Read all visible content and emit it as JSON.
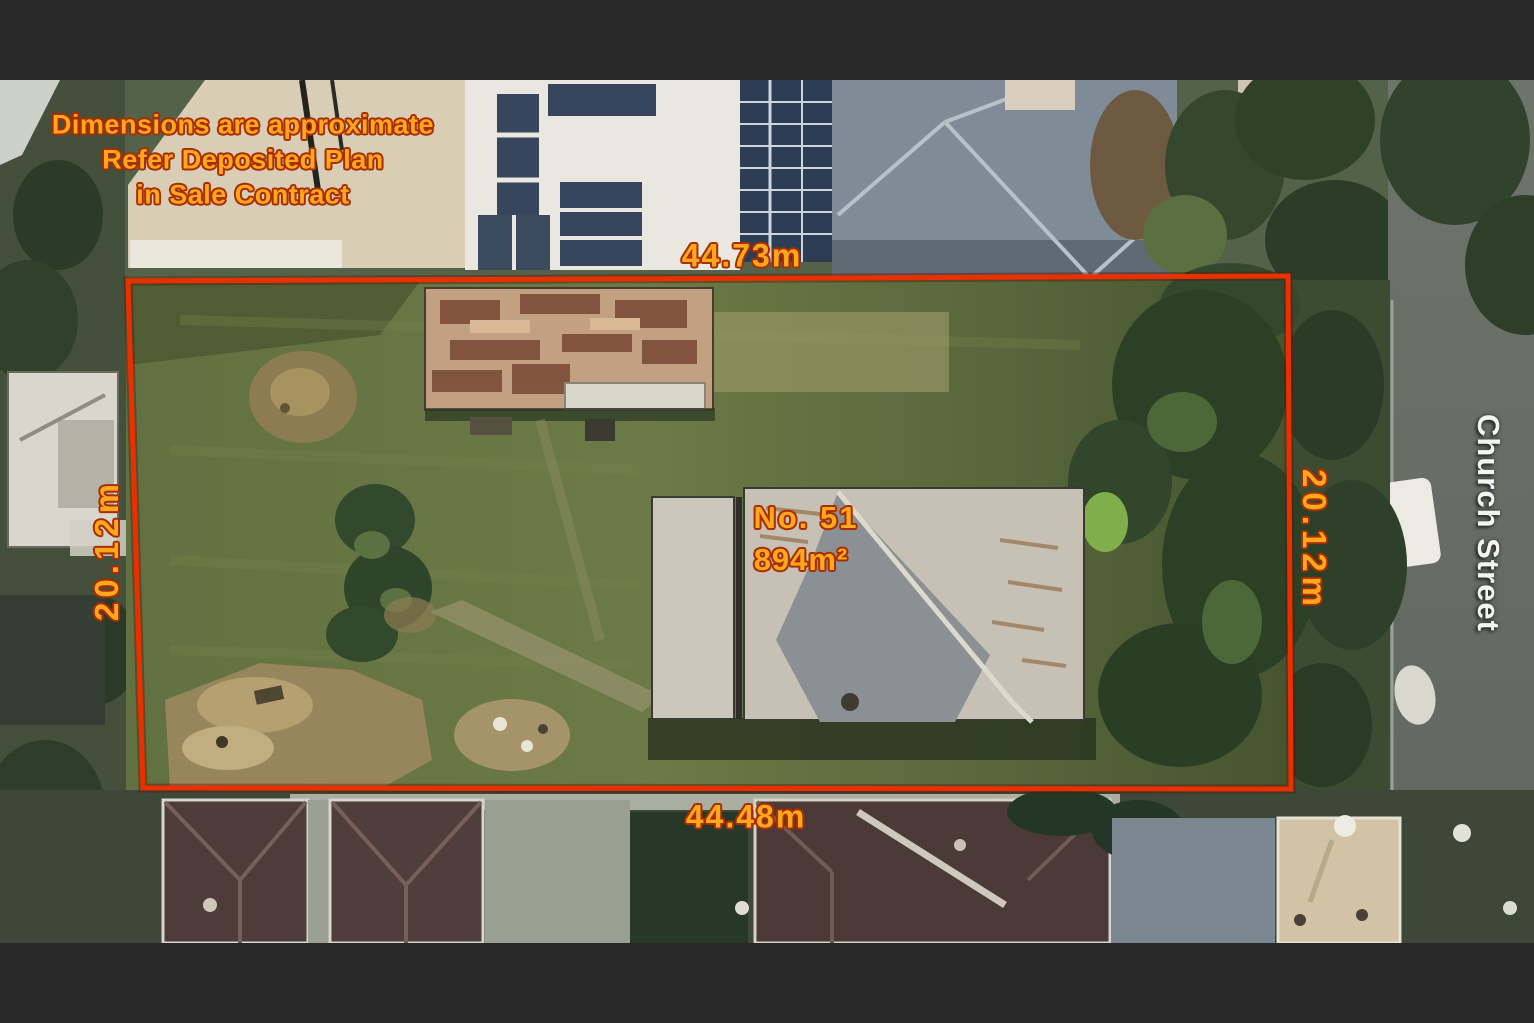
{
  "disclaimer": {
    "line1": "Dimensions are approximate",
    "line2": "Refer Deposited Plan",
    "line3": "in Sale Contract"
  },
  "dimensions": {
    "top": "44.73m",
    "bottom": "44.48m",
    "left": "20.12m",
    "right": "20.12m"
  },
  "lot": {
    "number": "No. 51",
    "area": "894m²"
  },
  "street": "Church Street",
  "colors": {
    "annotation_text": "#FFA81E",
    "annotation_outline": "#A82D00",
    "boundary": "#E83000",
    "street_text": "#F4F4F2",
    "letterbox": "#272727"
  }
}
